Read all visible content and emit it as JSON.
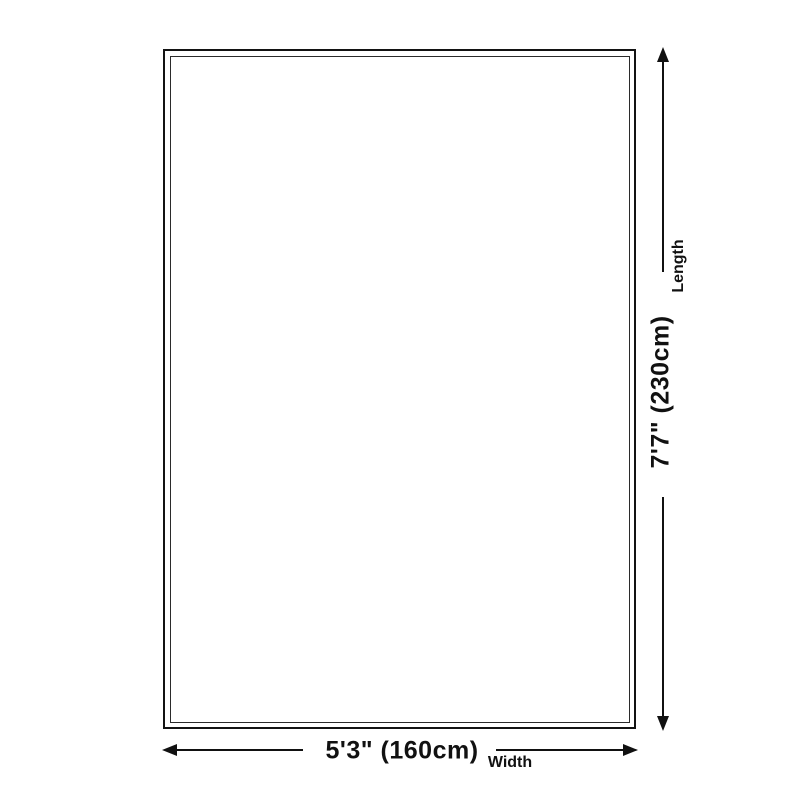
{
  "page": {
    "background_color": "#ffffff",
    "line_color": "#111111"
  },
  "diagram": {
    "rug": {
      "description": "empty rug outline with double border"
    },
    "length_dimension": {
      "value": "7'7\" (230cm)",
      "label": "Length"
    },
    "width_dimension": {
      "value": "5'3\" (160cm)",
      "label": "Width"
    },
    "icons": {
      "length_arrow": "double-headed-arrow-vertical",
      "width_arrow": "double-headed-arrow-horizontal"
    }
  }
}
